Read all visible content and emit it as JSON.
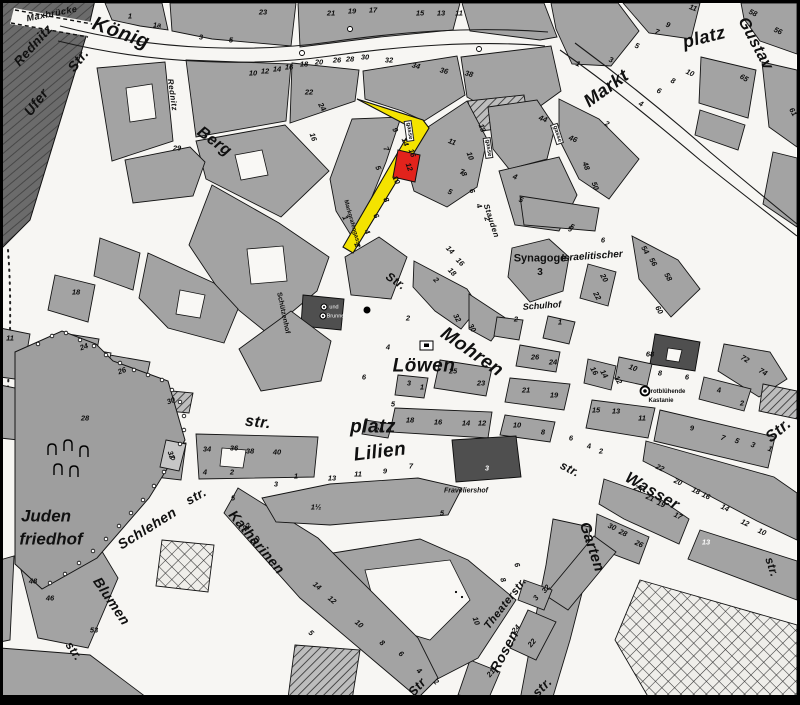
{
  "colors": {
    "building": "#a3a3a3",
    "building_dark": "#4f4f4f",
    "river": "#686868",
    "street": "#f7f6f3",
    "highlight_street": "#F4E300",
    "highlight_building": "#E2231C",
    "ink": "#111111"
  },
  "highlight": {
    "street_name": "Markgrafengasse",
    "building_number": "12"
  },
  "labels": [
    {
      "t": "Maxbrücke",
      "x": 52,
      "y": 14,
      "r": -11,
      "s": 9,
      "c": "st"
    },
    {
      "t": "Rednitz",
      "x": 33,
      "y": 45,
      "r": -48,
      "s": 13,
      "c": "st"
    },
    {
      "t": "König",
      "x": 121,
      "y": 33,
      "r": 20,
      "s": 20,
      "c": "st"
    },
    {
      "t": "Str.",
      "x": 78,
      "y": 60,
      "r": -52,
      "s": 14,
      "c": "st"
    },
    {
      "t": "Ufer",
      "x": 36,
      "y": 102,
      "r": -52,
      "s": 14,
      "c": "st"
    },
    {
      "t": "Rednitz",
      "x": 172,
      "y": 95,
      "r": 82,
      "s": 8,
      "c": "st"
    },
    {
      "t": "Berg",
      "x": 214,
      "y": 142,
      "r": 36,
      "s": 16,
      "c": "st"
    },
    {
      "t": "Markt",
      "x": 606,
      "y": 88,
      "r": -36,
      "s": 18,
      "c": "st"
    },
    {
      "t": "platz",
      "x": 704,
      "y": 37,
      "r": -14,
      "s": 18,
      "c": "st"
    },
    {
      "t": "Gustav",
      "x": 755,
      "y": 44,
      "r": 62,
      "s": 16,
      "c": "st"
    },
    {
      "t": "gasse",
      "x": 409,
      "y": 131,
      "r": 82,
      "s": 6,
      "c": "box"
    },
    {
      "t": "gasse",
      "x": 488,
      "y": 148,
      "r": 82,
      "s": 6,
      "c": "box"
    },
    {
      "t": "gasse",
      "x": 557,
      "y": 134,
      "r": 72,
      "s": 6,
      "c": "box"
    },
    {
      "t": "Markgrafengasse",
      "x": 352,
      "y": 224,
      "r": 74,
      "s": 6,
      "c": "tiny"
    },
    {
      "t": "Stauden",
      "x": 491,
      "y": 221,
      "r": 72,
      "s": 8,
      "c": "st"
    },
    {
      "t": "Schützenhof",
      "x": 283,
      "y": 313,
      "r": 78,
      "s": 7,
      "c": "tiny"
    },
    {
      "t": "Synagoge",
      "x": 540,
      "y": 259,
      "r": 0,
      "s": 11,
      "c": "plb"
    },
    {
      "t": "3",
      "x": 540,
      "y": 273,
      "r": 0,
      "s": 10,
      "c": "plb"
    },
    {
      "t": "Israelitischer",
      "x": 592,
      "y": 257,
      "r": -4,
      "s": 10,
      "c": "pl"
    },
    {
      "t": "Schulhof",
      "x": 542,
      "y": 306,
      "r": -4,
      "s": 9,
      "c": "pl"
    },
    {
      "t": "Str.",
      "x": 396,
      "y": 281,
      "r": 34,
      "s": 12,
      "c": "st"
    },
    {
      "t": "Mohren",
      "x": 472,
      "y": 352,
      "r": 35,
      "s": 19,
      "c": "st"
    },
    {
      "t": "Löwen",
      "x": 424,
      "y": 366,
      "r": 0,
      "s": 19,
      "c": "st"
    },
    {
      "t": "platz",
      "x": 373,
      "y": 427,
      "r": 0,
      "s": 19,
      "c": "st"
    },
    {
      "t": "str.",
      "x": 258,
      "y": 423,
      "r": 6,
      "s": 16,
      "c": "st"
    },
    {
      "t": "Lilien",
      "x": 380,
      "y": 452,
      "r": -7,
      "s": 19,
      "c": "st"
    },
    {
      "t": "str.",
      "x": 570,
      "y": 469,
      "r": 28,
      "s": 12,
      "c": "st"
    },
    {
      "t": "Wasser",
      "x": 652,
      "y": 492,
      "r": 30,
      "s": 16,
      "c": "st"
    },
    {
      "t": "Str.",
      "x": 779,
      "y": 431,
      "r": -40,
      "s": 16,
      "c": "st"
    },
    {
      "t": "str.",
      "x": 772,
      "y": 567,
      "r": 72,
      "s": 12,
      "c": "st"
    },
    {
      "t": "Garten",
      "x": 592,
      "y": 547,
      "r": 72,
      "s": 15,
      "c": "st"
    },
    {
      "t": "Juden",
      "x": 46,
      "y": 516,
      "r": 0,
      "s": 17,
      "c": "pl"
    },
    {
      "t": "friedhof",
      "x": 51,
      "y": 539,
      "r": 0,
      "s": 17,
      "c": "pl"
    },
    {
      "t": "Schlehen",
      "x": 147,
      "y": 528,
      "r": -32,
      "s": 14,
      "c": "st"
    },
    {
      "t": "str.",
      "x": 196,
      "y": 496,
      "r": -30,
      "s": 13,
      "c": "st"
    },
    {
      "t": "Katharinen",
      "x": 257,
      "y": 542,
      "r": 50,
      "s": 14,
      "c": "st"
    },
    {
      "t": "Str",
      "x": 417,
      "y": 687,
      "r": -48,
      "s": 13,
      "c": "st"
    },
    {
      "t": "Blumen",
      "x": 112,
      "y": 601,
      "r": 56,
      "s": 14,
      "c": "st"
    },
    {
      "t": "str.",
      "x": 74,
      "y": 651,
      "r": 56,
      "s": 12,
      "c": "st"
    },
    {
      "t": "Theaterstr.",
      "x": 506,
      "y": 604,
      "r": -52,
      "s": 11,
      "c": "st"
    },
    {
      "t": "Rosen",
      "x": 504,
      "y": 651,
      "r": -62,
      "s": 14,
      "c": "st"
    },
    {
      "t": "str.",
      "x": 542,
      "y": 687,
      "r": -45,
      "s": 13,
      "c": "st"
    },
    {
      "t": "rotblühende",
      "x": 668,
      "y": 392,
      "r": 0,
      "s": 6,
      "c": "tiny"
    },
    {
      "t": "Kastanie",
      "x": 661,
      "y": 401,
      "r": 0,
      "s": 6,
      "c": "tiny"
    },
    {
      "t": "Fraveliershof",
      "x": 466,
      "y": 491,
      "r": 0,
      "s": 7,
      "c": "pl"
    },
    {
      "t": "und",
      "x": 334,
      "y": 308,
      "r": 0,
      "s": 5.5,
      "c": "lt"
    },
    {
      "t": "Brunnen",
      "x": 337,
      "y": 317,
      "r": 0,
      "s": 5.5,
      "c": "lt"
    }
  ],
  "house_numbers": [
    [
      "1",
      130,
      16
    ],
    [
      "1a",
      157,
      25
    ],
    [
      "3",
      201,
      37
    ],
    [
      "5",
      231,
      40
    ],
    [
      "23",
      263,
      12
    ],
    [
      "21",
      331,
      13
    ],
    [
      "19",
      352,
      11
    ],
    [
      "17",
      373,
      10
    ],
    [
      "15",
      420,
      13
    ],
    [
      "13",
      441,
      13
    ],
    [
      "11",
      459,
      13
    ],
    [
      "11",
      693,
      8,
      20
    ],
    [
      "9",
      668,
      25,
      20
    ],
    [
      "7",
      657,
      32,
      20
    ],
    [
      "5",
      637,
      46,
      20
    ],
    [
      "3",
      611,
      60,
      20
    ],
    [
      "1",
      578,
      64,
      20
    ],
    [
      "58",
      753,
      13,
      25
    ],
    [
      "56",
      778,
      31,
      25
    ],
    [
      "65",
      744,
      78,
      30
    ],
    [
      "61",
      793,
      112,
      60
    ],
    [
      "2",
      607,
      124,
      25
    ],
    [
      "4",
      641,
      104,
      25
    ],
    [
      "6",
      659,
      91,
      25
    ],
    [
      "8",
      673,
      81,
      25
    ],
    [
      "10",
      690,
      73,
      25
    ],
    [
      "10",
      253,
      73
    ],
    [
      "12",
      265,
      71
    ],
    [
      "14",
      277,
      69
    ],
    [
      "16",
      289,
      67
    ],
    [
      "18",
      304,
      64
    ],
    [
      "20",
      319,
      62
    ],
    [
      "26",
      337,
      60
    ],
    [
      "28",
      350,
      59
    ],
    [
      "30",
      365,
      57
    ],
    [
      "32",
      389,
      60
    ],
    [
      "34",
      416,
      66,
      15
    ],
    [
      "36",
      444,
      71,
      15
    ],
    [
      "38",
      469,
      74,
      15
    ],
    [
      "22",
      309,
      92
    ],
    [
      "24",
      322,
      107,
      60
    ],
    [
      "16",
      313,
      137,
      70
    ],
    [
      "29",
      177,
      148
    ],
    [
      "9",
      395,
      130,
      65
    ],
    [
      "7",
      386,
      149,
      65
    ],
    [
      "5",
      378,
      168,
      65
    ],
    [
      "1",
      345,
      218,
      65
    ],
    [
      "10",
      396,
      180,
      65
    ],
    [
      "8",
      386,
      200,
      65
    ],
    [
      "6",
      376,
      216,
      65
    ],
    [
      "4",
      367,
      232,
      65
    ],
    [
      "2",
      357,
      245,
      65
    ],
    [
      "14",
      405,
      142,
      70
    ],
    [
      "16",
      412,
      153,
      70
    ],
    [
      "12",
      409,
      167,
      70
    ],
    [
      "11",
      452,
      142,
      20
    ],
    [
      "13",
      482,
      128,
      70
    ],
    [
      "7",
      462,
      172,
      20
    ],
    [
      "5",
      450,
      192,
      20
    ],
    [
      "10",
      470,
      156,
      70
    ],
    [
      "8",
      464,
      174,
      70
    ],
    [
      "6",
      472,
      191,
      70
    ],
    [
      "4",
      479,
      206,
      70
    ],
    [
      "2",
      487,
      219,
      70
    ],
    [
      "44",
      543,
      119,
      20
    ],
    [
      "46",
      573,
      139,
      20
    ],
    [
      "48",
      586,
      166,
      70
    ],
    [
      "50",
      595,
      186,
      70
    ],
    [
      "4",
      515,
      177,
      20
    ],
    [
      "5",
      521,
      200,
      20
    ],
    [
      "5",
      572,
      227,
      20
    ],
    [
      "14",
      450,
      250,
      45
    ],
    [
      "16",
      460,
      262,
      45
    ],
    [
      "18",
      452,
      272,
      45
    ],
    [
      "2",
      436,
      280,
      45
    ],
    [
      "5",
      570,
      229
    ],
    [
      "6",
      603,
      240
    ],
    [
      "2",
      516,
      319
    ],
    [
      "1",
      560,
      322
    ],
    [
      "20",
      604,
      278,
      60
    ],
    [
      "22",
      597,
      296,
      60
    ],
    [
      "54",
      645,
      250,
      60
    ],
    [
      "56",
      653,
      262,
      60
    ],
    [
      "58",
      668,
      277,
      60
    ],
    [
      "60",
      659,
      310,
      60
    ],
    [
      "2",
      408,
      318
    ],
    [
      "32",
      457,
      318,
      60
    ],
    [
      "30",
      472,
      328,
      60
    ],
    [
      "26",
      535,
      357
    ],
    [
      "24",
      553,
      362
    ],
    [
      "25",
      453,
      371
    ],
    [
      "23",
      481,
      383
    ],
    [
      "21",
      526,
      390
    ],
    [
      "19",
      554,
      395
    ],
    [
      "4",
      388,
      347
    ],
    [
      "6",
      364,
      377
    ],
    [
      "3",
      409,
      383
    ],
    [
      "1",
      422,
      387
    ],
    [
      "5",
      393,
      404
    ],
    [
      "20",
      379,
      430
    ],
    [
      "18",
      410,
      420
    ],
    [
      "16",
      438,
      422
    ],
    [
      "14",
      466,
      423
    ],
    [
      "12",
      482,
      423
    ],
    [
      "10",
      517,
      425
    ],
    [
      "8",
      543,
      432
    ],
    [
      "68",
      650,
      354
    ],
    [
      "10",
      633,
      368,
      20
    ],
    [
      "8",
      660,
      373
    ],
    [
      "6",
      687,
      377
    ],
    [
      "16",
      594,
      371,
      60
    ],
    [
      "14",
      604,
      374,
      60
    ],
    [
      "12",
      618,
      380,
      60
    ],
    [
      "72",
      745,
      359,
      30
    ],
    [
      "74",
      763,
      372,
      30
    ],
    [
      "4",
      719,
      390
    ],
    [
      "2",
      742,
      403
    ],
    [
      "15",
      596,
      410
    ],
    [
      "13",
      616,
      411
    ],
    [
      "11",
      642,
      418
    ],
    [
      "9",
      692,
      428
    ],
    [
      "7",
      723,
      438,
      20
    ],
    [
      "5",
      737,
      441,
      20
    ],
    [
      "3",
      753,
      445,
      20
    ],
    [
      "1",
      770,
      449,
      20
    ],
    [
      "22",
      660,
      468,
      25
    ],
    [
      "20",
      678,
      482,
      25
    ],
    [
      "18",
      696,
      491,
      25
    ],
    [
      "16",
      706,
      496,
      25
    ],
    [
      "14",
      725,
      508,
      25
    ],
    [
      "12",
      745,
      523,
      25
    ],
    [
      "10",
      762,
      532,
      25
    ],
    [
      "23",
      638,
      489,
      25
    ],
    [
      "21",
      650,
      498,
      25
    ],
    [
      "19",
      661,
      504,
      25
    ],
    [
      "17",
      678,
      516,
      25
    ],
    [
      "30",
      612,
      527,
      25
    ],
    [
      "28",
      623,
      533,
      25
    ],
    [
      "26",
      639,
      544,
      25
    ],
    [
      "6",
      571,
      438
    ],
    [
      "4",
      589,
      446
    ],
    [
      "2",
      601,
      451
    ],
    [
      "13",
      706,
      542,
      0,
      true
    ],
    [
      "14",
      317,
      586,
      40
    ],
    [
      "12",
      332,
      600,
      40
    ],
    [
      "10",
      359,
      624,
      40
    ],
    [
      "8",
      382,
      643,
      40
    ],
    [
      "6",
      401,
      654,
      40
    ],
    [
      "4",
      419,
      671,
      40
    ],
    [
      "2",
      436,
      682,
      40
    ],
    [
      "5",
      311,
      633,
      40
    ],
    [
      "10",
      476,
      621,
      70
    ],
    [
      "8",
      503,
      580,
      70
    ],
    [
      "6",
      517,
      565,
      70
    ],
    [
      "24",
      516,
      629,
      -50
    ],
    [
      "22",
      532,
      643,
      -50
    ],
    [
      "21",
      491,
      673,
      -50
    ],
    [
      "3",
      536,
      598,
      -50
    ],
    [
      "32",
      546,
      589,
      -50
    ],
    [
      "18",
      76,
      292
    ],
    [
      "11",
      10,
      338
    ],
    [
      "24",
      84,
      347,
      -20
    ],
    [
      "26",
      122,
      371,
      -20
    ],
    [
      "28",
      85,
      418
    ],
    [
      "30",
      171,
      401,
      -20
    ],
    [
      "32",
      171,
      455,
      70
    ],
    [
      "34",
      207,
      449
    ],
    [
      "36",
      234,
      448
    ],
    [
      "38",
      250,
      451
    ],
    [
      "40",
      277,
      452
    ],
    [
      "4",
      205,
      472
    ],
    [
      "2",
      232,
      472
    ],
    [
      "5",
      233,
      498
    ],
    [
      "3",
      276,
      484
    ],
    [
      "1",
      296,
      476
    ],
    [
      "13",
      332,
      478
    ],
    [
      "1½",
      316,
      507
    ],
    [
      "11",
      358,
      474
    ],
    [
      "9",
      385,
      471
    ],
    [
      "7",
      411,
      466
    ],
    [
      "22",
      247,
      527,
      -40
    ],
    [
      "20",
      256,
      540,
      -40
    ],
    [
      "48",
      33,
      581
    ],
    [
      "46",
      50,
      598
    ],
    [
      "53",
      94,
      630
    ],
    [
      "3",
      487,
      468,
      0,
      true
    ],
    [
      "5",
      442,
      513
    ]
  ],
  "symbols": [
    {
      "name": "fountain-dot-symbol",
      "x": 367,
      "y": 310
    },
    {
      "name": "well-symbol",
      "x": 324,
      "y": 307
    },
    {
      "name": "well-symbol",
      "x": 323,
      "y": 316
    },
    {
      "name": "chestnut-tree-symbol",
      "x": 645,
      "y": 391
    },
    {
      "name": "monument-symbol",
      "x": 426,
      "y": 345
    },
    {
      "name": "cemetery-gate-symbol",
      "x": 52,
      "y": 450
    },
    {
      "name": "cemetery-gate-symbol",
      "x": 68,
      "y": 446
    },
    {
      "name": "cemetery-gate-symbol",
      "x": 84,
      "y": 452
    },
    {
      "name": "cemetery-gate-symbol",
      "x": 58,
      "y": 470
    },
    {
      "name": "cemetery-gate-symbol",
      "x": 74,
      "y": 472
    },
    {
      "name": "street-lamp-symbol",
      "x": 350,
      "y": 29
    },
    {
      "name": "street-lamp-symbol",
      "x": 302,
      "y": 53
    },
    {
      "name": "street-lamp-symbol",
      "x": 479,
      "y": 49
    },
    {
      "name": "dot-symbol",
      "x": 456,
      "y": 592
    },
    {
      "name": "dot-symbol",
      "x": 462,
      "y": 597
    }
  ]
}
